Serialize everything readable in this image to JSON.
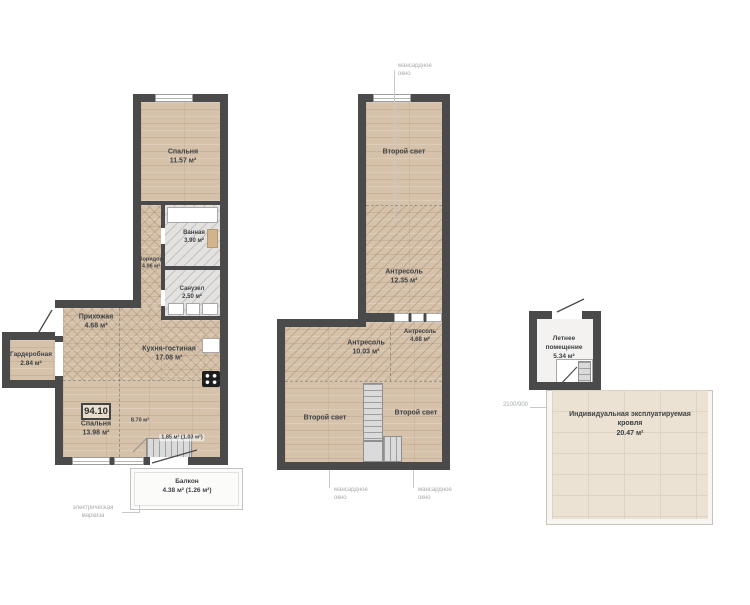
{
  "level1": {
    "total_area": "94.10",
    "rooms": {
      "bedroom1": {
        "name": "Спальня",
        "area": "11.57 м²"
      },
      "bathroom": {
        "name": "Ванная",
        "area": "3.90 м²"
      },
      "corridor": {
        "name": "Коридор",
        "area": "4.06 м²"
      },
      "wc": {
        "name": "Санузел",
        "area": "2.50 м²"
      },
      "hallway": {
        "name": "Прихожая",
        "area": "4.68 м²"
      },
      "wardrobe": {
        "name": "Гардеробная",
        "area": "2.84 м²"
      },
      "kitchen_living": {
        "name": "Кухня-гостиная",
        "area": "17.08 м²"
      },
      "bedroom2": {
        "name": "Спальня",
        "area": "13.98 м²"
      },
      "stair": {
        "area": "8.70 м²"
      },
      "stair_opening": {
        "area": "1.85 м² (1.03 м²)"
      },
      "balcony": {
        "name": "Балкон",
        "area": "4.38 м² (1.26 м²)"
      }
    },
    "annotations": {
      "awning": "электрическая маркиза"
    }
  },
  "level2": {
    "rooms": {
      "second_light_top": {
        "name": "Второй свет"
      },
      "mezzanine_top": {
        "name": "Антресоль",
        "area": "12.35 м²"
      },
      "mezzanine_left": {
        "name": "Антресоль",
        "area": "10.03 м²"
      },
      "mezzanine_right": {
        "name": "Антресоль",
        "area": "4.68 м²"
      },
      "second_light_bottom_left": {
        "name": "Второй свет"
      },
      "second_light_bottom_right": {
        "name": "Второй свет"
      }
    },
    "annotations": {
      "skylight_top": "мансардное окно",
      "skylight_bottom_left": "мансардное окно",
      "skylight_bottom_right": "мансардное окно"
    }
  },
  "roof": {
    "rooms": {
      "summer_room": {
        "name": "Летнее помещение",
        "area": "5.34 м²"
      },
      "terrace": {
        "name": "Индивидуальная эксплуатируемая кровля",
        "area": "20.47 м²"
      }
    },
    "annotations": {
      "dimension": "2100/900"
    }
  },
  "colors": {
    "wall": "#4a4a4a",
    "wood_floor": "#d6c2aa",
    "tile_floor": "#e3e2e1",
    "roof_tile": "#ebe2d4",
    "annotation_text": "#a7abae",
    "label_text": "#3d4144"
  }
}
